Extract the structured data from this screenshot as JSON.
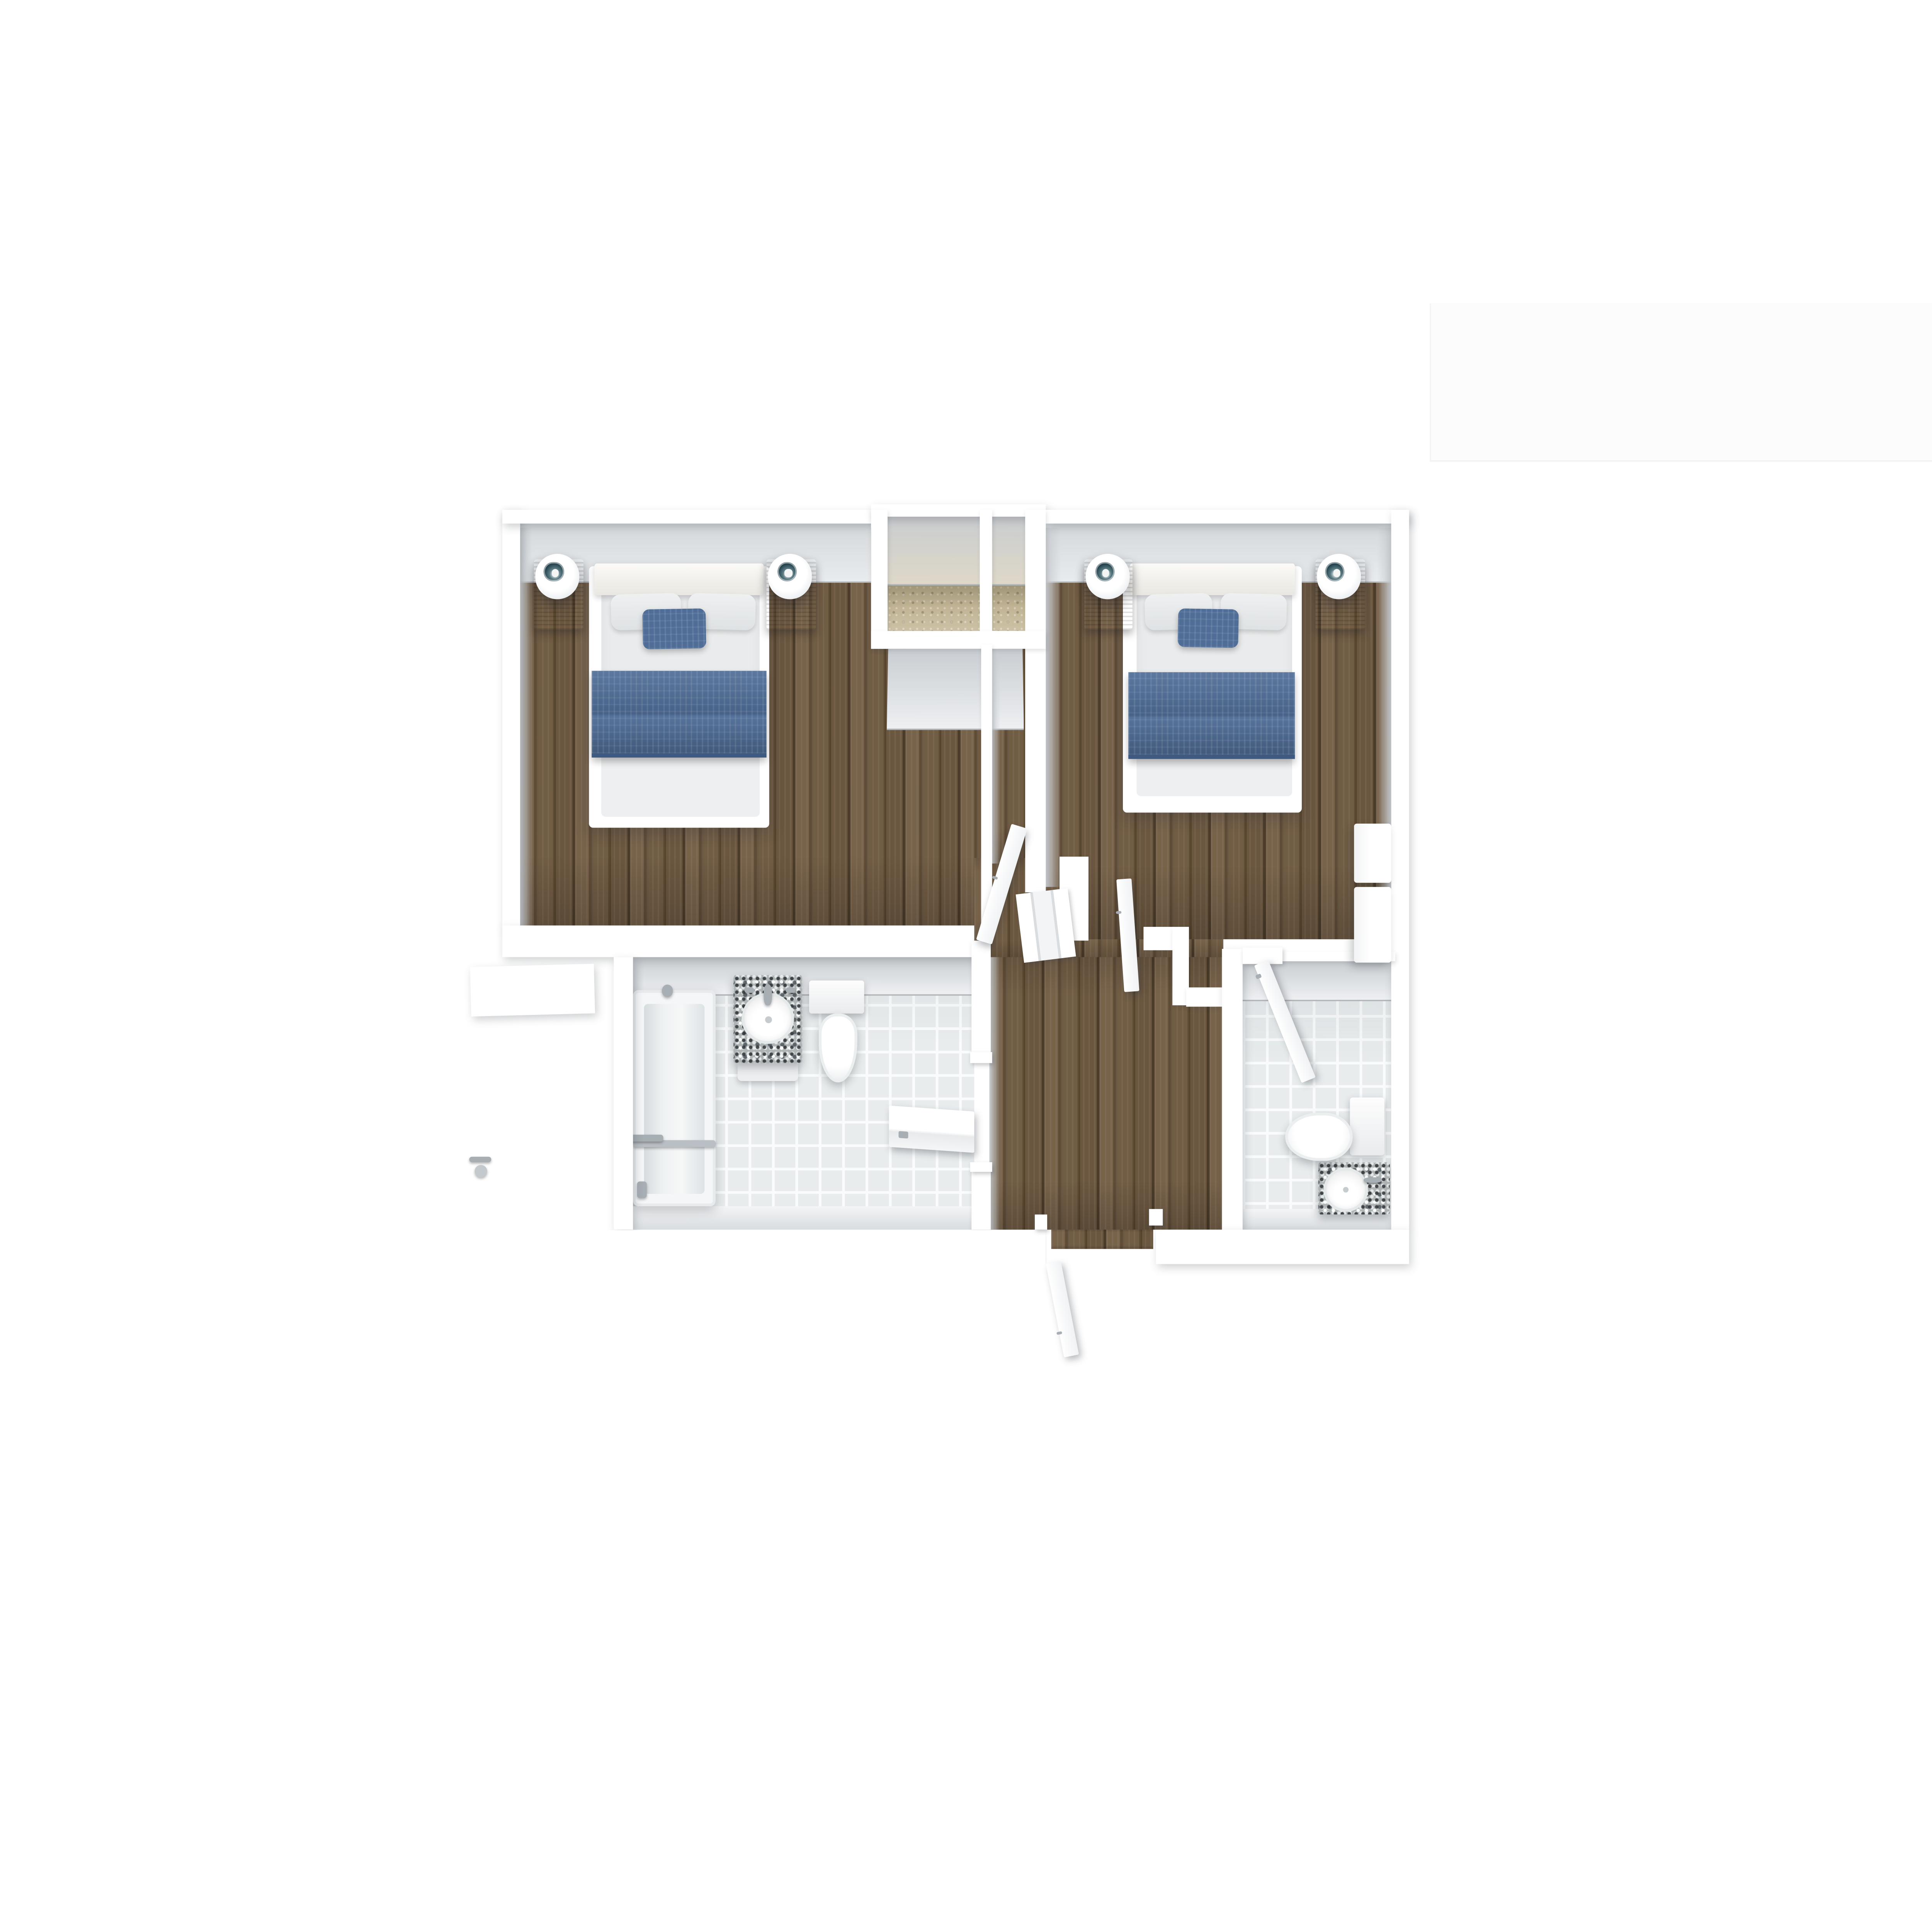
{
  "scene": {
    "type": "3d-floorplan-top-down-render",
    "level": "upper-floor",
    "rooms": [
      {
        "id": "bedroom-left",
        "kind": "bedroom",
        "floor": "wood",
        "furniture": [
          "double-bed",
          "headboard",
          "blue-accent-pillow",
          "blue-bed-runner",
          "nightstand-left",
          "nightstand-right",
          "table-lamp-left",
          "table-lamp-right"
        ]
      },
      {
        "id": "bedroom-right",
        "kind": "bedroom",
        "floor": "wood",
        "furniture": [
          "double-bed",
          "headboard",
          "blue-accent-pillow",
          "blue-bed-runner",
          "nightstand-left",
          "nightstand-right",
          "table-lamp-left",
          "table-lamp-right",
          "dresser"
        ]
      },
      {
        "id": "bathroom-left",
        "kind": "bathroom",
        "floor": "tile",
        "fixtures": [
          "bathtub-shower",
          "granite-vanity-with-round-sink",
          "toilet"
        ]
      },
      {
        "id": "bathroom-right",
        "kind": "bathroom",
        "floor": "tile",
        "fixtures": [
          "toilet",
          "granite-vanity-with-round-sink"
        ]
      },
      {
        "id": "hallway",
        "kind": "hall",
        "floor": "wood"
      },
      {
        "id": "stair-niche-left",
        "kind": "landing",
        "floor": "carpet"
      },
      {
        "id": "stair-niche-right",
        "kind": "landing",
        "floor": "carpet"
      }
    ],
    "doors": [
      {
        "id": "entry-door",
        "state": "open",
        "swing": "outward-bottom"
      },
      {
        "id": "bedroom-left-door",
        "state": "open"
      },
      {
        "id": "bedroom-right-door",
        "state": "open"
      },
      {
        "id": "bathroom-left-door",
        "state": "open"
      },
      {
        "id": "bathroom-right-door",
        "state": "open"
      }
    ]
  },
  "palette": {
    "--page-bg": "#ffffff",
    "--wall": "#ffffff",
    "--face-dark": "#c9cdd1",
    "--face-light": "#eef0f2",
    "--wood-base": "#6e5941",
    "--wood-light": "#7d6950",
    "--wood-dark": "#4f3e2b",
    "--carpet": "#c8bb9c",
    "--tile-base": "#e8eced",
    "--tile-grout": "#f9fbfc",
    "--fabric-blue": "#4f6d97",
    "--bedding": "#e9ebec",
    "--headboard": "#f7f5f0",
    "--nightstand": "#6b553c",
    "--granite": "#aeb4b4",
    "--chrome": "#a7aeb4",
    "--lamp-lens": "#24434d"
  }
}
